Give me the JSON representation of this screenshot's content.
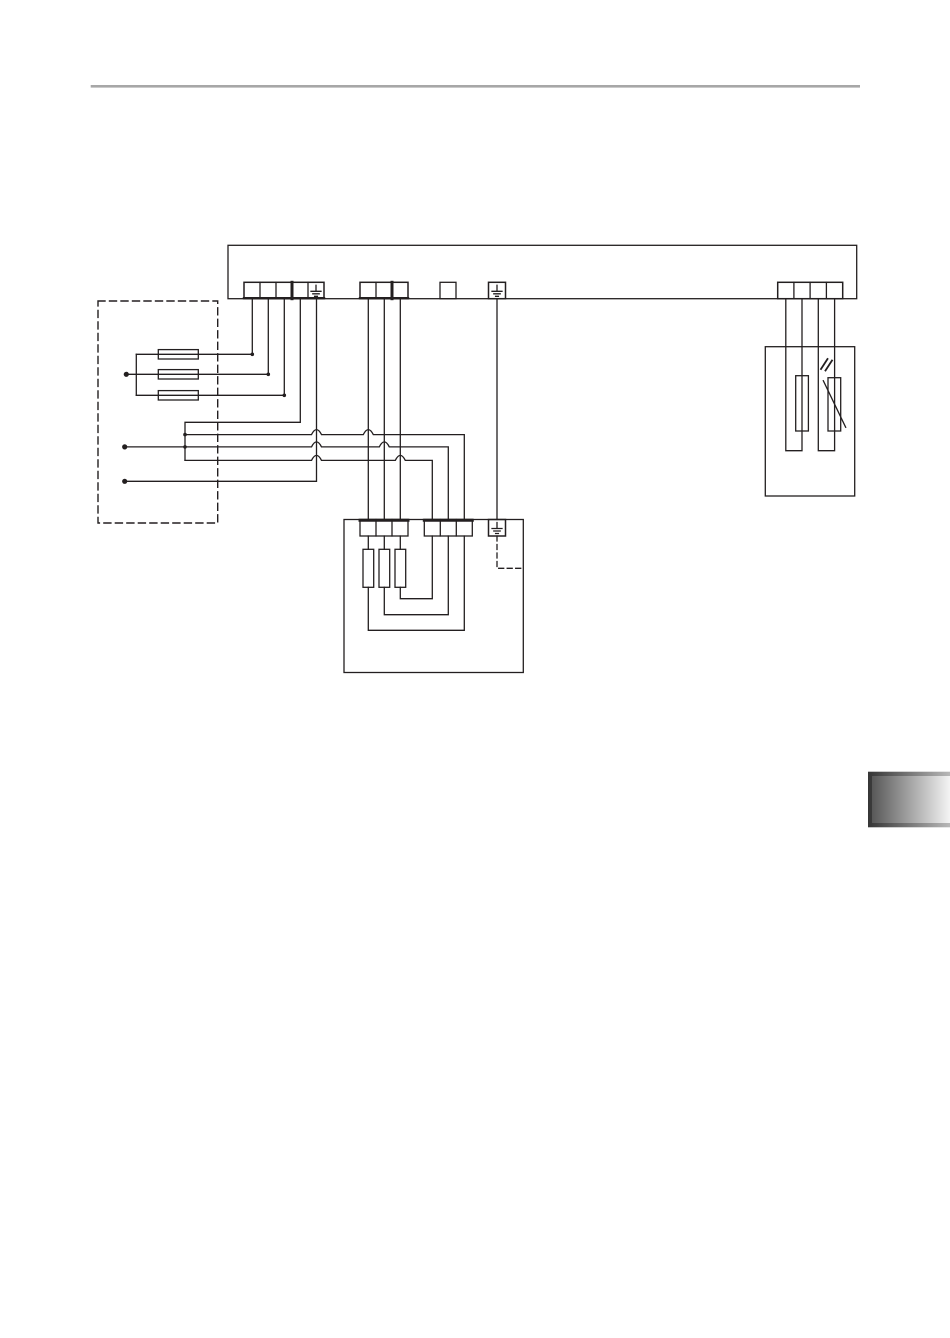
{
  "page": {
    "width_px": 950,
    "height_px": 1338,
    "background": "#ffffff"
  },
  "header_rule": {
    "color": "#a7a7a7"
  },
  "diagram": {
    "type": "wiring-schematic",
    "line_color": "#231f20",
    "earth_symbol_count": 3,
    "fuse_count": 3,
    "current_transformer_count": 3,
    "sensor_element_count": 2
  },
  "page_tab": {
    "edge_gradient_from": "#353535",
    "edge_gradient_to": "#b8b8b8",
    "face_gradient_from": "#585858",
    "face_gradient_to": "#f4f4f4"
  }
}
